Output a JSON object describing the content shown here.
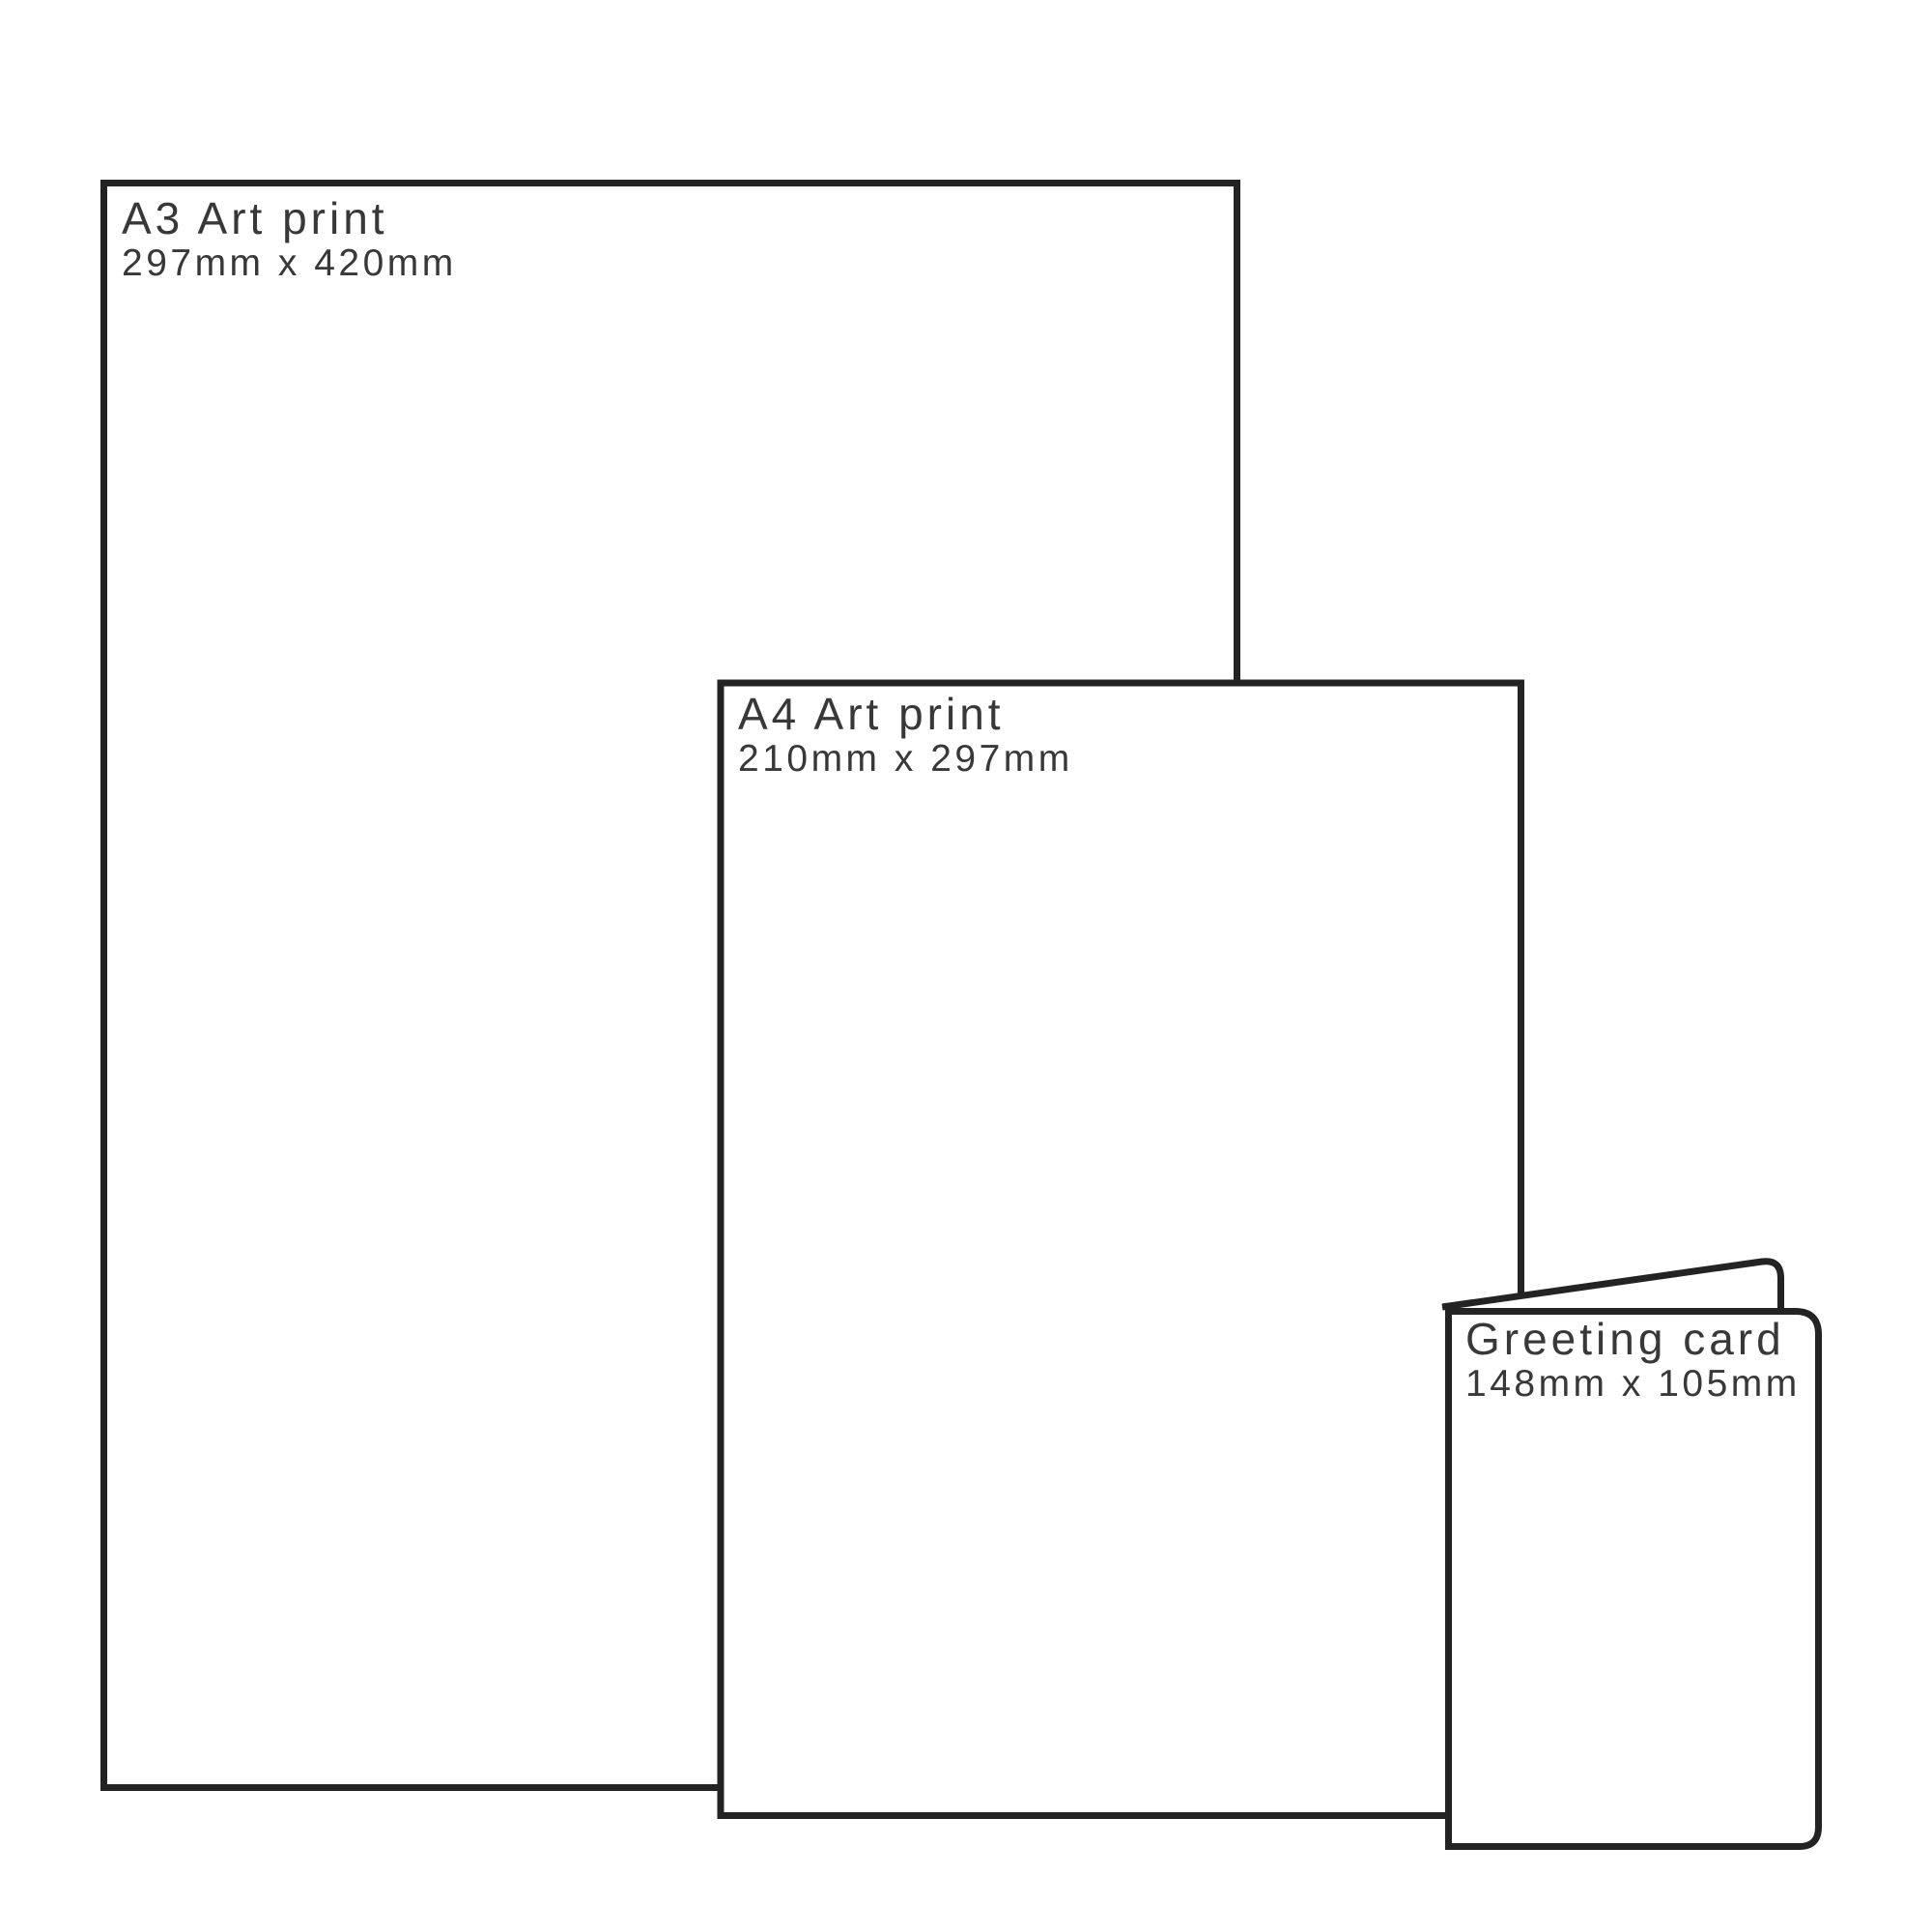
{
  "diagram": {
    "description": "Print size comparison",
    "background_color": "#ffffff",
    "outline_color": "#232323",
    "text_color": "#383838"
  },
  "papers": [
    {
      "id": "a3-print",
      "title": "A3 Art print",
      "dimensions": "297mm x 420mm"
    },
    {
      "id": "a4-print",
      "title": "A4 Art print",
      "dimensions": "210mm x 297mm"
    },
    {
      "id": "greeting-card",
      "title": "Greeting card",
      "dimensions": "148mm x 105mm"
    }
  ]
}
